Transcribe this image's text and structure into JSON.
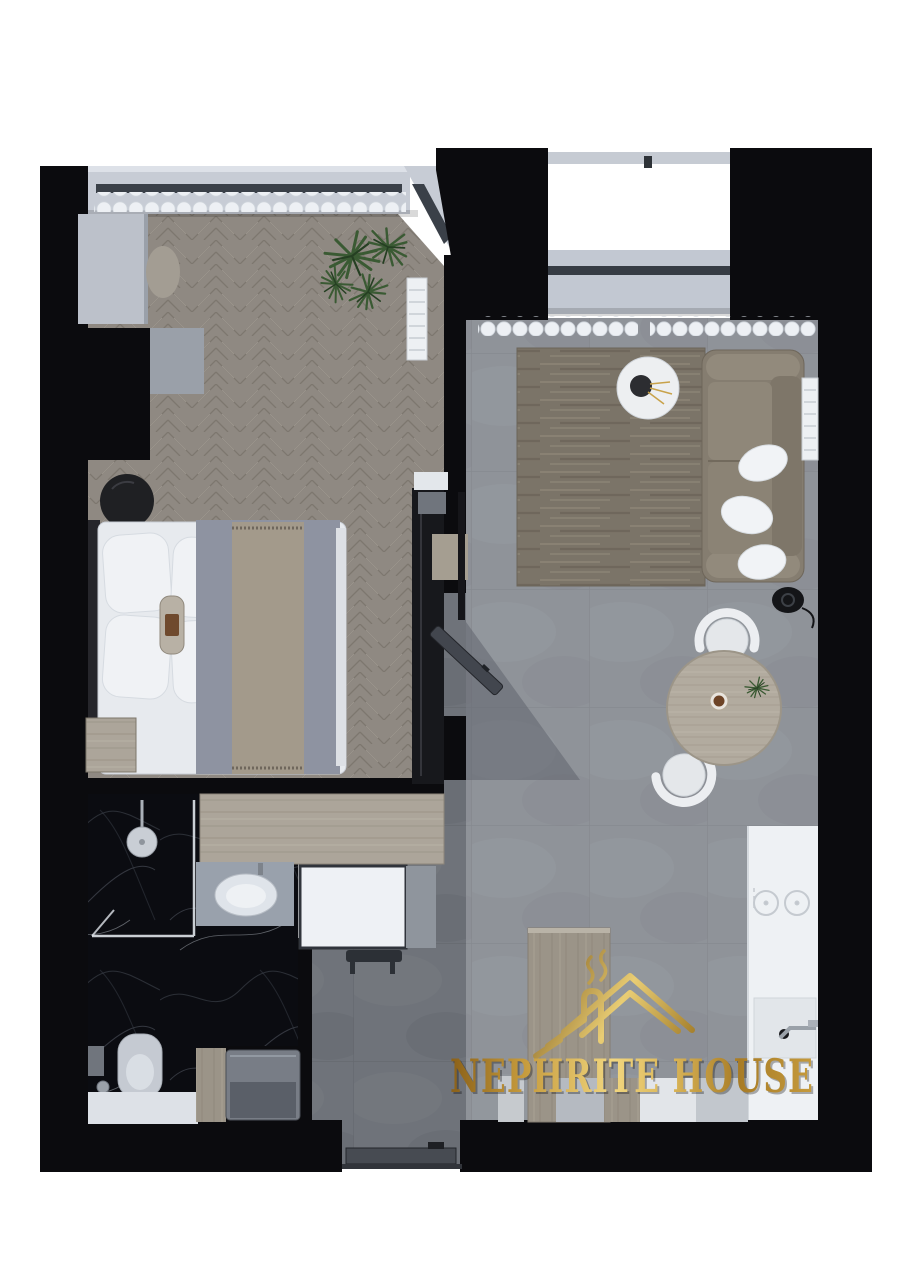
{
  "logo": {
    "text": "NEPHRITE HOUSE",
    "icon": "gold-roof-chimney-smoke-logo-icon"
  },
  "palette": {
    "background": "#ffffff",
    "wall": "#0b0b0e",
    "gold_dark": "#8a6018",
    "gold_light": "#f1d67f",
    "bedroom_floor": "#8f8982",
    "living_floor": "#8f9399",
    "hallway_floor": "#6f737a",
    "bathroom_marble": "#0b0c11",
    "wood_light": "#aca59a",
    "sofa": "#857d70",
    "rug": "#7b7468",
    "kitchen_counter": "#eef1f4",
    "curtain": "#edf0f4",
    "plant_green": "#3a5a33"
  }
}
